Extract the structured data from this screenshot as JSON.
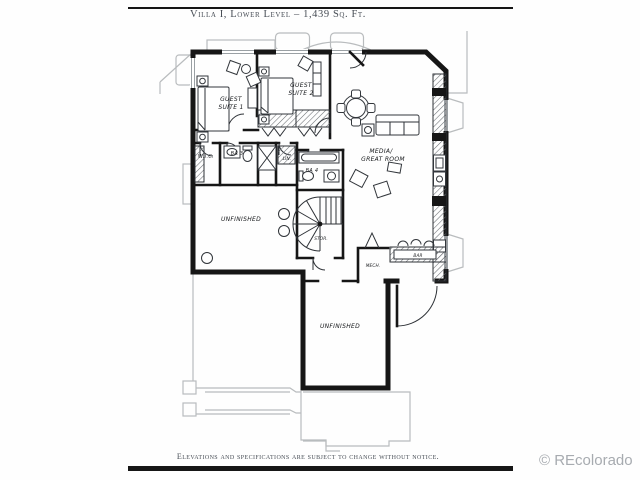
{
  "page": {
    "title": "Villa I, Lower Level – 1,439 Sq. Ft.",
    "disclaimer": "Elevations and specifications are subject to change without notice.",
    "watermark": "© REcolorado"
  },
  "plan": {
    "rooms": {
      "guest_suite_1": {
        "line1": "GUEST",
        "line2": "SUITE 1"
      },
      "guest_suite_2": {
        "line1": "GUEST",
        "line2": "SUITE 2"
      },
      "media_great_room": {
        "line1": "MEDIA/",
        "line2": "GREAT ROOM"
      },
      "unfinished_upper": {
        "label": "UNFINISHED"
      },
      "unfinished_lower": {
        "label": "UNFINISHED"
      },
      "wic": {
        "label": "W.I.C."
      },
      "bath3": {
        "label": "BA 3"
      },
      "bath4": {
        "label": "BA 4"
      },
      "linen": {
        "label": "LIN."
      },
      "storage": {
        "label": "STOR."
      },
      "mech": {
        "label": "MECH."
      },
      "bar": {
        "label": "BAR"
      }
    }
  },
  "colors": {
    "wall": "#161616",
    "site_outline": "#b9bcbe",
    "ink": "#474d55",
    "watermark": "#a7abb0"
  }
}
